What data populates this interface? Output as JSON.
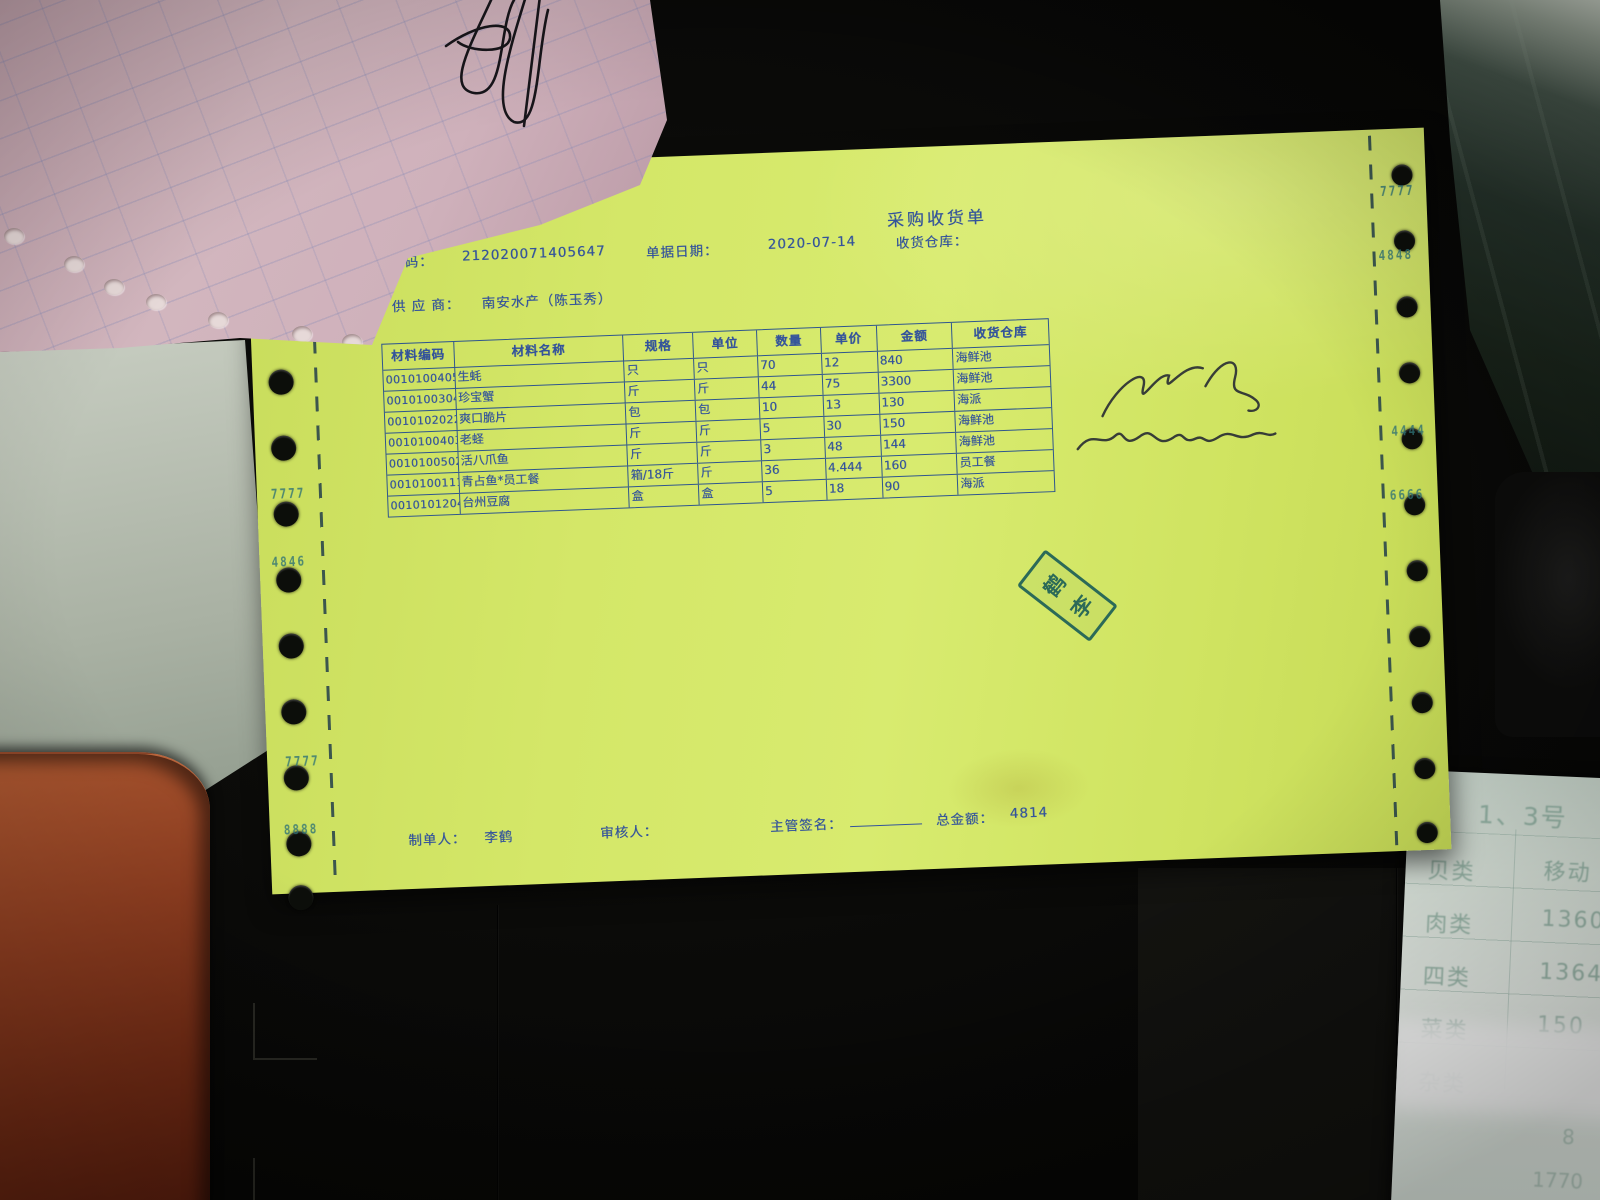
{
  "document": {
    "title": "采购收货单",
    "header_fields": {
      "code_label": "编码：",
      "code_value": "212020071405647",
      "date_label": "单据日期：",
      "date_value": "2020-07-14",
      "warehouse_label": "收货仓库：",
      "supplier_label": "供 应 商：",
      "supplier_value": "南安水产（陈玉秀）"
    },
    "table": {
      "headers": [
        "材料编码",
        "材料名称",
        "规格",
        "单位",
        "数量",
        "单价",
        "金额",
        "收货仓库"
      ],
      "rows": [
        [
          "0010100405",
          "生蚝",
          "只",
          "只",
          "70",
          "12",
          "840",
          "海鲜池"
        ],
        [
          "0010100304",
          "珍宝蟹",
          "斤",
          "斤",
          "44",
          "75",
          "3300",
          "海鲜池"
        ],
        [
          "0010102022",
          "爽口脆片",
          "包",
          "包",
          "10",
          "13",
          "130",
          "海派"
        ],
        [
          "0010100403",
          "老蛏",
          "斤",
          "斤",
          "5",
          "30",
          "150",
          "海鲜池"
        ],
        [
          "0010100502",
          "活八爪鱼",
          "斤",
          "斤",
          "3",
          "48",
          "144",
          "海鲜池"
        ],
        [
          "0010100111",
          "青占鱼*员工餐",
          "箱/18斤",
          "斤",
          "36",
          "4.444",
          "160",
          "员工餐"
        ],
        [
          "0010101204",
          "台州豆腐",
          "盒",
          "盒",
          "5",
          "18",
          "90",
          "海派"
        ]
      ]
    },
    "footer": {
      "maker_label": "制单人：",
      "maker_value": "李鹤",
      "reviewer_label": "审核人：",
      "supervisor_label": "主管签名：",
      "total_label": "总金额：",
      "total_value": "4814"
    },
    "stamp": {
      "top_char": "鹤",
      "bottom_char": "李"
    },
    "tractor_marks_left": [
      "7777",
      "4846",
      "7777",
      "8888"
    ],
    "tractor_marks_right": [
      "7777",
      "4848",
      "4444",
      "6666"
    ]
  },
  "side_receipt": {
    "header": "1、3号",
    "rows": [
      {
        "label": "贝类",
        "value": "移动"
      },
      {
        "label": "肉类",
        "value": "1360"
      },
      {
        "label": "四类",
        "value": "1364"
      },
      {
        "label": "菜类",
        "value": "150"
      },
      {
        "label": "杂类",
        "value": ""
      }
    ],
    "faint_values": [
      "8",
      "1770"
    ]
  },
  "colors": {
    "paper_green": "#d4e768",
    "print_blue": "#33539b",
    "stamp_teal": "#1d6057",
    "paper_pink": "#cbadb6"
  }
}
